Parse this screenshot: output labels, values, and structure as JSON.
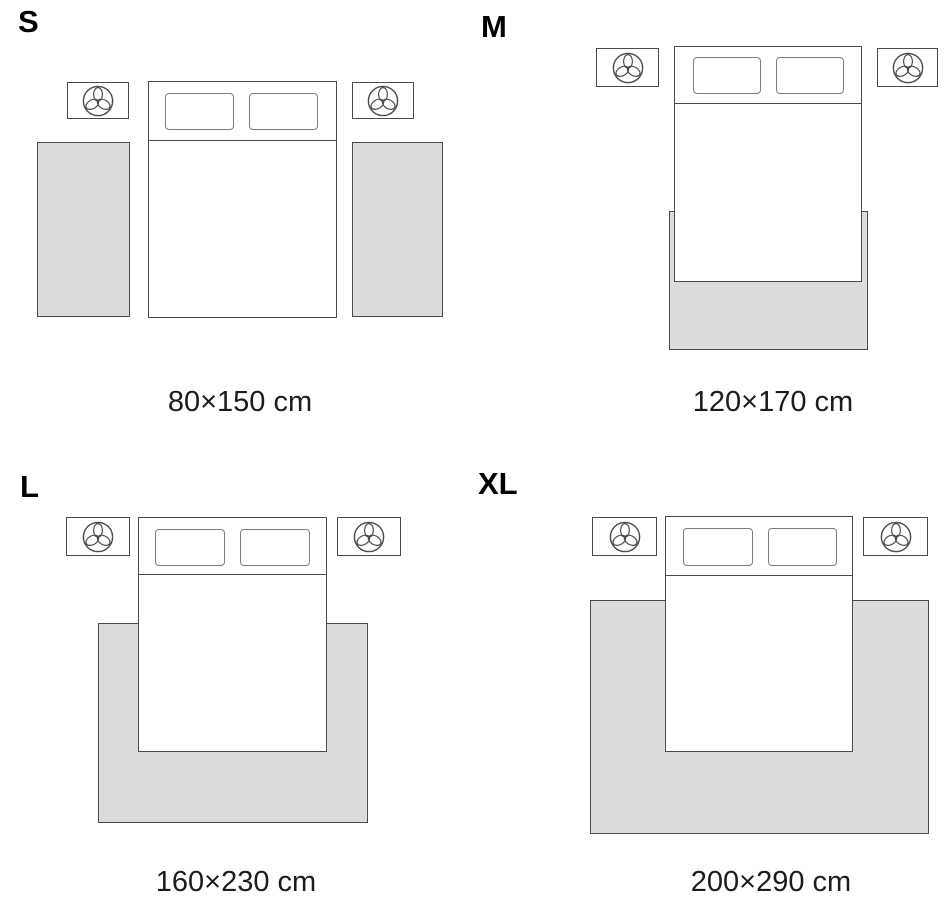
{
  "panels": {
    "s": {
      "letter": "S",
      "dimensions": "80×150 cm"
    },
    "m": {
      "letter": "M",
      "dimensions": "120×170 cm"
    },
    "l": {
      "letter": "L",
      "dimensions": "160×230 cm"
    },
    "xl": {
      "letter": "XL",
      "dimensions": "200×290 cm"
    }
  },
  "icons": {
    "nightstand_decor": "plant-top-view-icon"
  },
  "colors": {
    "background": "#ffffff",
    "rug_fill": "#dcdcdc",
    "furniture_outline": "#4a4a4a",
    "pillow_outline": "#7d7d7d",
    "size_letter_text": "#000000",
    "dimension_text": "#1c1c1c"
  }
}
